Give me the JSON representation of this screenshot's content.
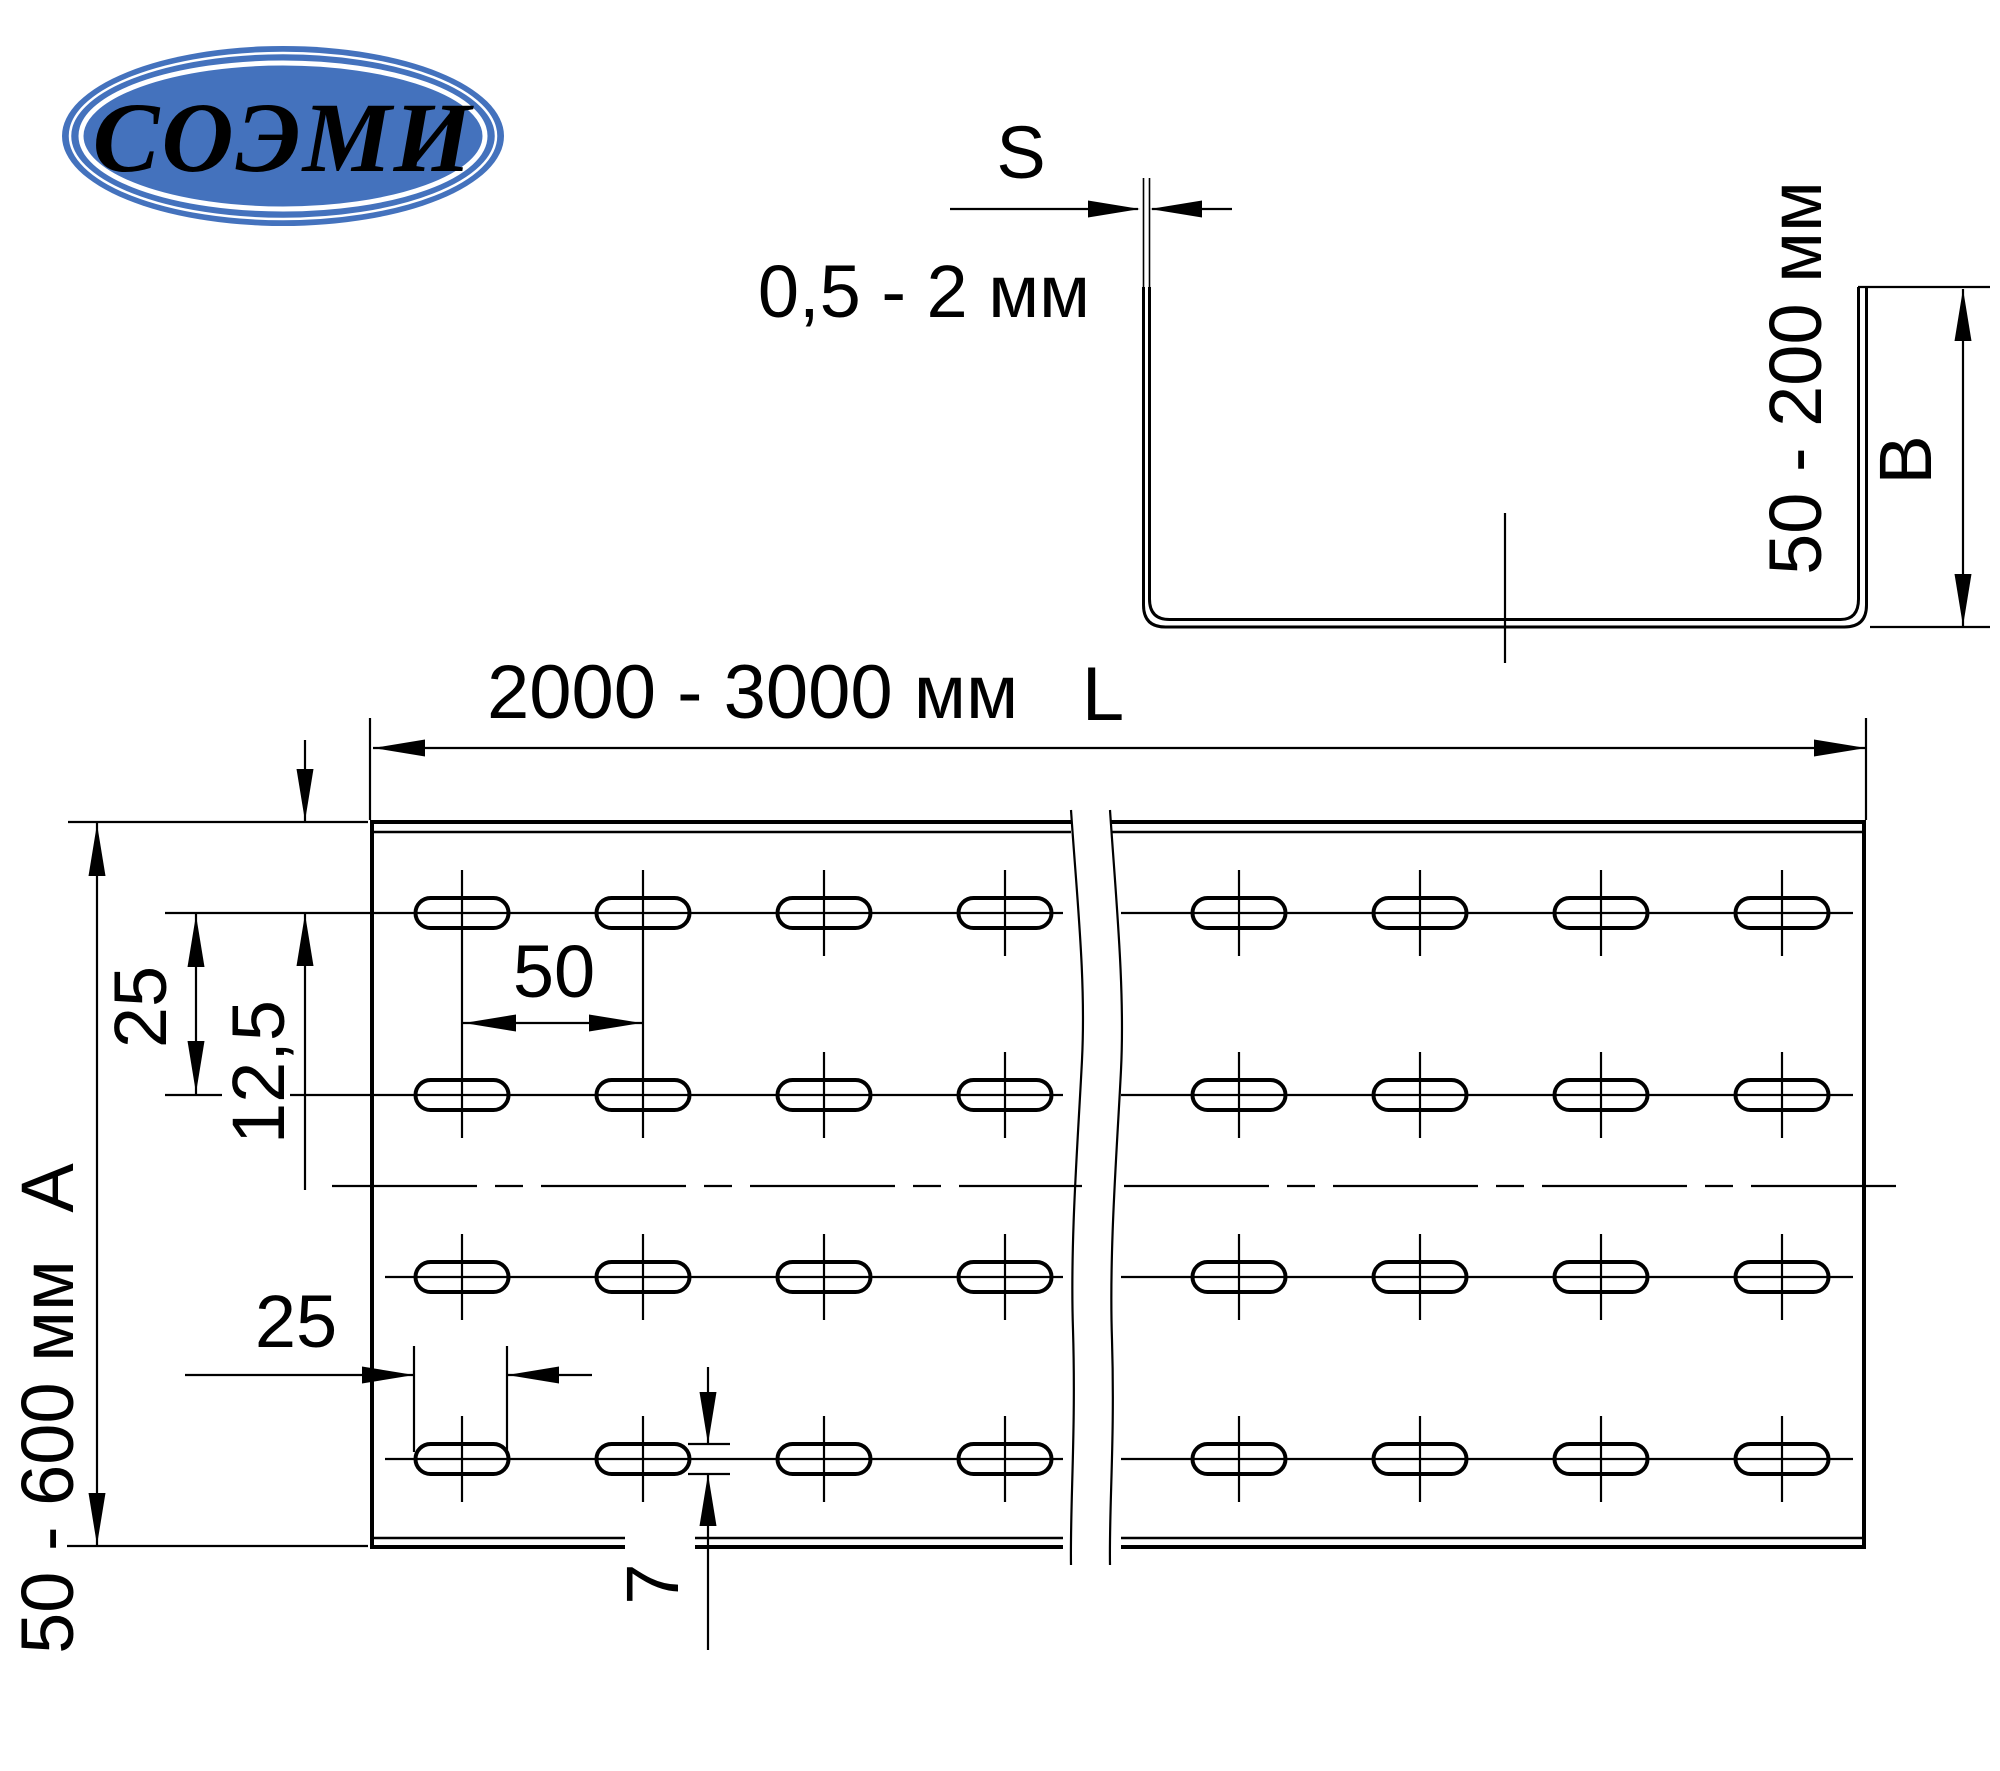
{
  "logo": {
    "text": "СОЭМИ",
    "bg_color": "#4472bd",
    "ring_color": "#ffffff",
    "text_color": "#ffffff"
  },
  "profile_view": {
    "thickness_label": "S",
    "thickness_value": "0,5 - 2 мм",
    "height_value": "50 - 200 мм",
    "height_label": "B"
  },
  "plan_view": {
    "length_value": "2000 - 3000 мм",
    "length_label": "L",
    "width_value": "50 - 600 мм",
    "width_label": "А",
    "row_spacing_value": "25",
    "edge_offset_value": "12,5",
    "hole_pitch_value": "50",
    "hole_length_value": "25",
    "hole_width_value": "7"
  },
  "drawing_data": {
    "line_color": "#000000",
    "slot_rows_y": [
      913,
      1095,
      1277,
      1459
    ],
    "slot_cols_x": [
      462,
      643,
      824,
      1005,
      1239,
      1420,
      1601,
      1782
    ],
    "long_tick_cols_x": [
      462,
      643
    ],
    "slot_length_px": 93,
    "slot_width_px": 30,
    "tick_half_px": 43
  }
}
